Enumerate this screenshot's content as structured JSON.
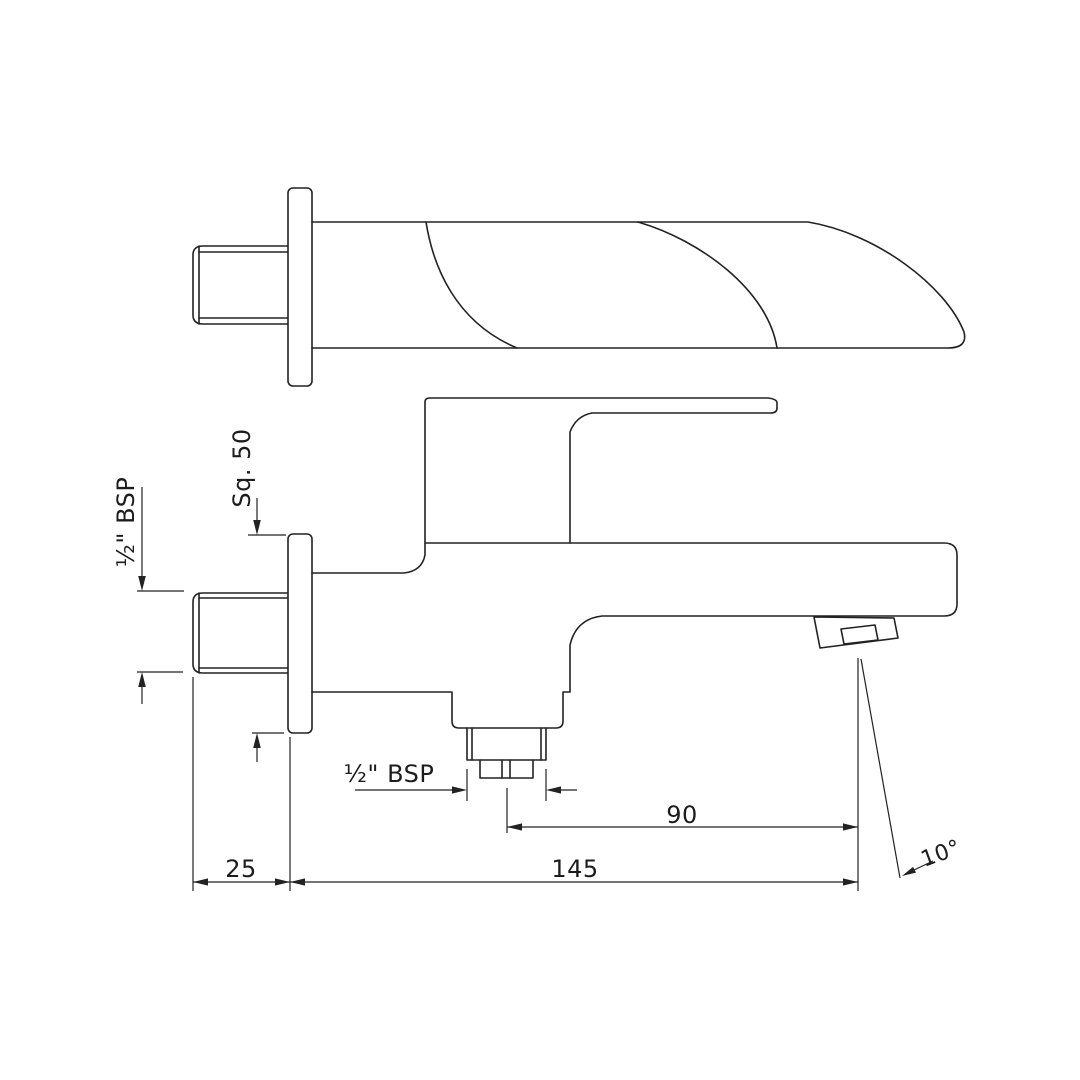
{
  "drawing": {
    "title_hint": "Bath spout technical drawing, two orthographic views",
    "background": "#ffffff",
    "line_color": "#222222",
    "labels": {
      "flange_square": "Sq. 50",
      "inlet_thread": "½\" BSP",
      "outlet_thread": "½\" BSP",
      "outlet_to_tip": "90",
      "wall_to_tip": "145",
      "wall_offset": "25",
      "spout_angle": "10°"
    }
  }
}
